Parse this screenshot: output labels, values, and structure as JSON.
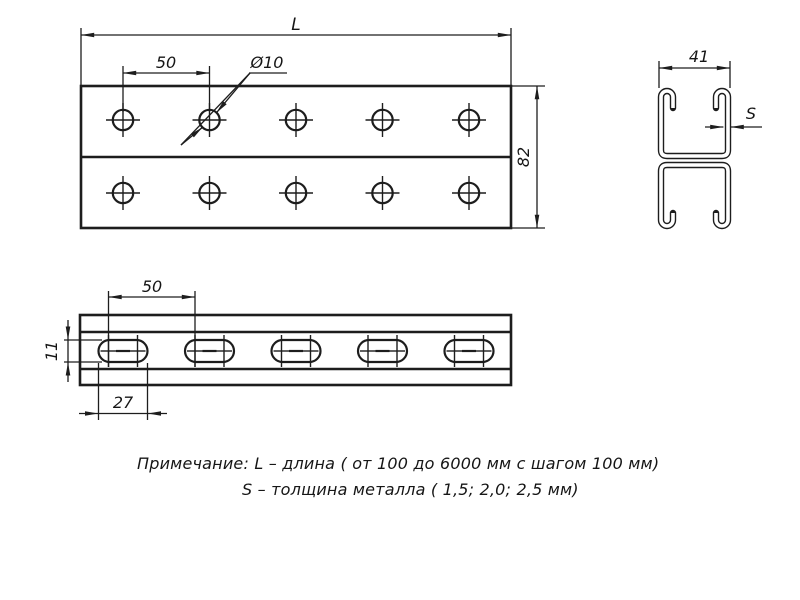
{
  "drawing": {
    "colors": {
      "line": "#1d1d1d",
      "background": "#ffffff"
    },
    "views": {
      "top_view": {
        "length_label": "L",
        "pitch_label": "50",
        "hole_label": "Ø10",
        "height_label": "82",
        "hole_columns": [
          123,
          209.5,
          296,
          382.5,
          469
        ],
        "hole_rows": [
          120,
          193
        ]
      },
      "section_view": {
        "width_label": "41",
        "thickness_label": "S"
      },
      "side_view": {
        "pitch_label": "50",
        "slot_length_label": "27",
        "slot_width_label": "11",
        "slot_columns": [
          123,
          209.5,
          296,
          382.5,
          469
        ],
        "slot_row_y": 351
      }
    },
    "notes": {
      "line1": "Примечание: L – длина ( от 100 до 6000 мм с шагом 100 мм)",
      "line2": "S – толщина металла ( 1,5; 2,0; 2,5 мм)"
    }
  }
}
